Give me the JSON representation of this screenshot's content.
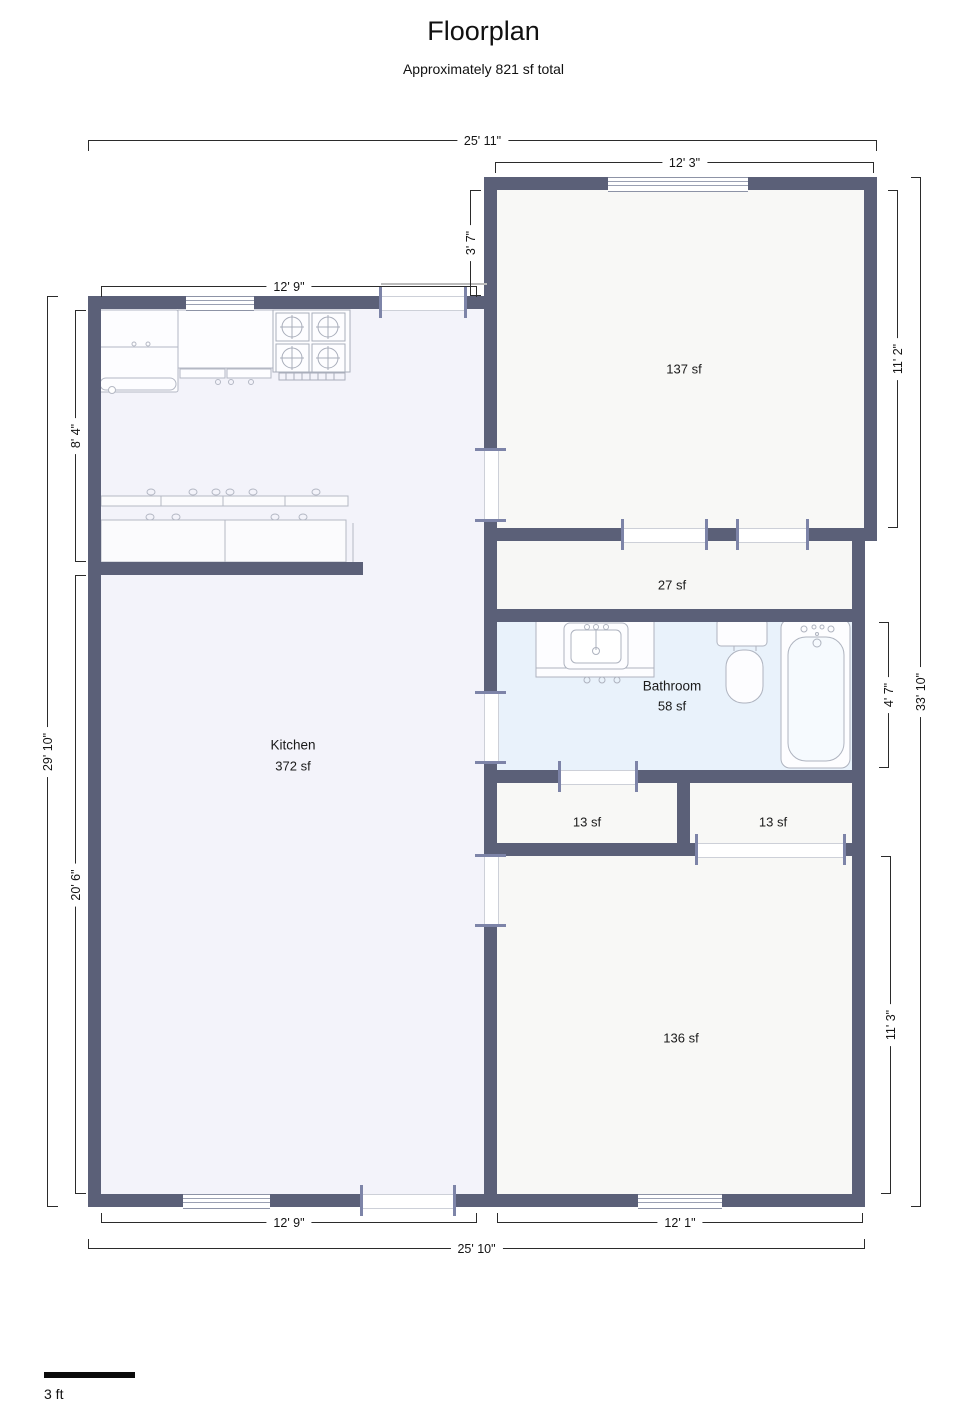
{
  "title": "Floorplan",
  "subtitle": "Approximately 821 sf total",
  "rooms": {
    "kitchen": {
      "name": "Kitchen",
      "area": "372 sf"
    },
    "room_137": {
      "area": "137 sf"
    },
    "hallway": {
      "area": "27 sf"
    },
    "bathroom": {
      "name": "Bathroom",
      "area": "58 sf"
    },
    "closet_left": {
      "area": "13 sf"
    },
    "closet_right": {
      "area": "13 sf"
    },
    "room_136": {
      "area": "136 sf"
    }
  },
  "dimensions": {
    "top_total": "25' 11\"",
    "top_room": "12' 3\"",
    "kitchen_top": "12' 9\"",
    "connector_height": "3' 7\"",
    "kitchen_upper_height": "8' 4\"",
    "left_total": "29' 10\"",
    "kitchen_lower_height": "20' 6\"",
    "room137_height": "11' 2\"",
    "right_total": "33' 10\"",
    "bathroom_height": "4' 7\"",
    "room136_height": "11' 3\"",
    "kitchen_bottom": "12' 9\"",
    "room136_bottom": "12' 1\"",
    "bottom_total": "25' 10\""
  },
  "scale_bar": {
    "label": "3 ft"
  },
  "colors": {
    "wall": "#5b6078",
    "jamb": "#7d84a8",
    "floor_main": "#f8f8f6",
    "floor_kitchen": "#f3f3fa",
    "floor_bathroom": "#e9f2fb"
  }
}
